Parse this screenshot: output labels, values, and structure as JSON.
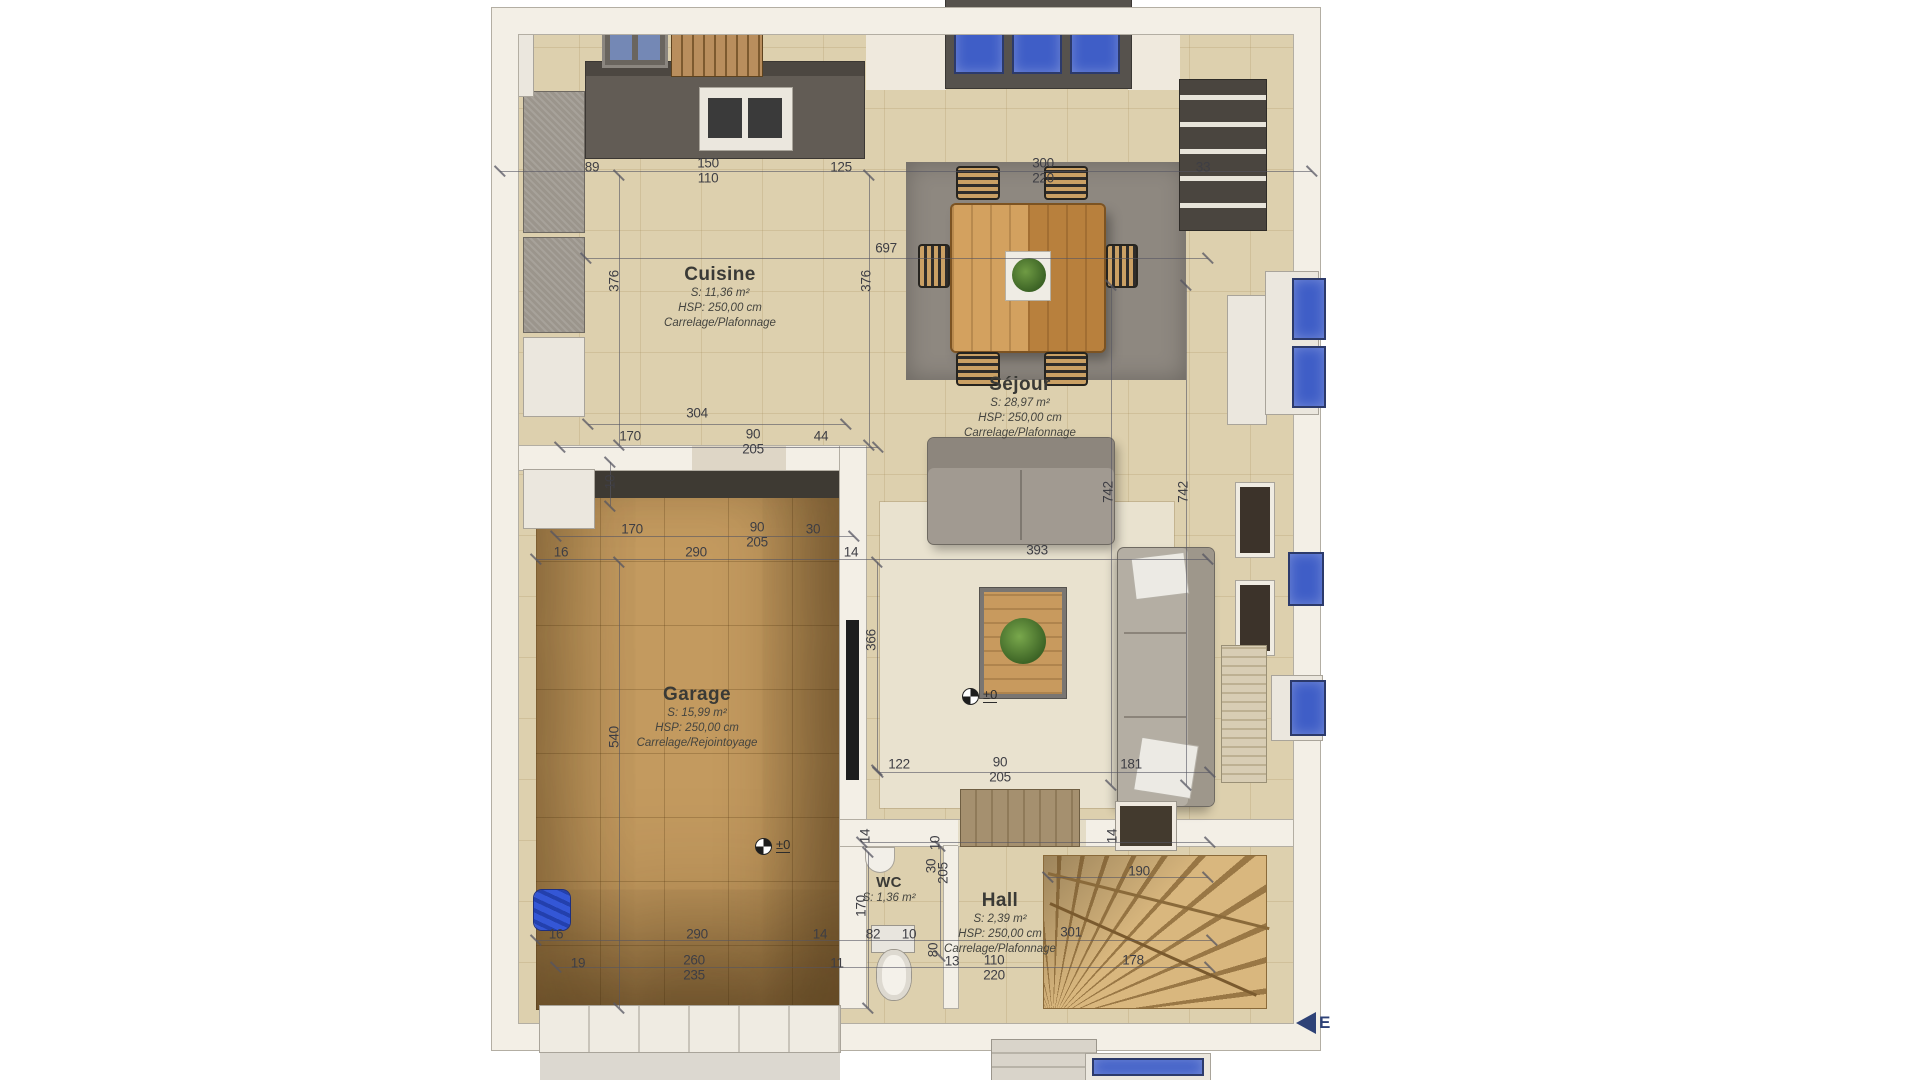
{
  "plan": {
    "rooms": [
      {
        "id": "cuisine",
        "name": "Cuisine",
        "area": "S: 11,36 m²",
        "height": "HSP: 250,00 cm",
        "finish": "Carrelage/Plafonnage"
      },
      {
        "id": "sejour",
        "name": "Séjour",
        "area": "S: 28,97 m²",
        "height": "HSP: 250,00 cm",
        "finish": "Carrelage/Plafonnage"
      },
      {
        "id": "garage",
        "name": "Garage",
        "area": "S: 15,99 m²",
        "height": "HSP: 250,00 cm",
        "finish": "Carrelage/Rejointoyage"
      },
      {
        "id": "wc",
        "name": "WC",
        "area": "S: 1,36 m²",
        "height": "",
        "finish": ""
      },
      {
        "id": "hall",
        "name": "Hall",
        "area": "S: 2,39 m²",
        "height": "HSP: 250,00 cm",
        "finish": "Carrelage/Plafonnage"
      }
    ],
    "level_markers": [
      {
        "label": "±0"
      },
      {
        "label": "±0"
      }
    ],
    "compass": {
      "label": "E"
    },
    "dimensions": [
      {
        "v": "89",
        "x": 592,
        "y": 167
      },
      {
        "v": "150",
        "x": 708,
        "y": 163
      },
      {
        "v": "110",
        "x": 708,
        "y": 178
      },
      {
        "v": "125",
        "x": 841,
        "y": 167
      },
      {
        "v": "300",
        "x": 1043,
        "y": 163
      },
      {
        "v": "220",
        "x": 1043,
        "y": 178
      },
      {
        "v": "33",
        "x": 1203,
        "y": 167
      },
      {
        "v": "697",
        "x": 886,
        "y": 248
      },
      {
        "v": "376",
        "x": 614,
        "y": 281,
        "r": 1
      },
      {
        "v": "376",
        "x": 866,
        "y": 281,
        "r": 1
      },
      {
        "v": "304",
        "x": 697,
        "y": 413
      },
      {
        "v": "170",
        "x": 630,
        "y": 436
      },
      {
        "v": "90",
        "x": 753,
        "y": 434
      },
      {
        "v": "205",
        "x": 753,
        "y": 449
      },
      {
        "v": "44",
        "x": 821,
        "y": 436
      },
      {
        "v": "10",
        "x": 610,
        "y": 482,
        "r": 1
      },
      {
        "v": "170",
        "x": 632,
        "y": 529
      },
      {
        "v": "90",
        "x": 757,
        "y": 527
      },
      {
        "v": "205",
        "x": 757,
        "y": 542
      },
      {
        "v": "30",
        "x": 813,
        "y": 529
      },
      {
        "v": "16",
        "x": 561,
        "y": 552
      },
      {
        "v": "290",
        "x": 696,
        "y": 552
      },
      {
        "v": "14",
        "x": 851,
        "y": 552
      },
      {
        "v": "393",
        "x": 1037,
        "y": 550
      },
      {
        "v": "366",
        "x": 871,
        "y": 640,
        "r": 1
      },
      {
        "v": "742",
        "x": 1108,
        "y": 492,
        "r": 1
      },
      {
        "v": "742",
        "x": 1183,
        "y": 492,
        "r": 1
      },
      {
        "v": "122",
        "x": 899,
        "y": 764
      },
      {
        "v": "90",
        "x": 1000,
        "y": 762
      },
      {
        "v": "205",
        "x": 1000,
        "y": 777
      },
      {
        "v": "181",
        "x": 1131,
        "y": 764
      },
      {
        "v": "540",
        "x": 614,
        "y": 737,
        "r": 1
      },
      {
        "v": "290",
        "x": 697,
        "y": 934
      },
      {
        "v": "16",
        "x": 556,
        "y": 934
      },
      {
        "v": "14",
        "x": 820,
        "y": 934
      },
      {
        "v": "82",
        "x": 873,
        "y": 934
      },
      {
        "v": "10",
        "x": 909,
        "y": 934
      },
      {
        "v": "19",
        "x": 578,
        "y": 963
      },
      {
        "v": "260",
        "x": 694,
        "y": 960
      },
      {
        "v": "235",
        "x": 694,
        "y": 975
      },
      {
        "v": "11",
        "x": 837,
        "y": 963
      },
      {
        "v": "80",
        "x": 933,
        "y": 950,
        "r": 1
      },
      {
        "v": "13",
        "x": 952,
        "y": 961
      },
      {
        "v": "110",
        "x": 994,
        "y": 960
      },
      {
        "v": "220",
        "x": 994,
        "y": 975
      },
      {
        "v": "178",
        "x": 1133,
        "y": 960
      },
      {
        "v": "301",
        "x": 1071,
        "y": 932
      },
      {
        "v": "190",
        "x": 1139,
        "y": 871
      },
      {
        "v": "170",
        "x": 861,
        "y": 906,
        "r": 1
      },
      {
        "v": "205",
        "x": 943,
        "y": 873,
        "r": 1
      },
      {
        "v": "30",
        "x": 931,
        "y": 866,
        "r": 1
      },
      {
        "v": "14",
        "x": 865,
        "y": 836,
        "r": 1
      },
      {
        "v": "10",
        "x": 935,
        "y": 843,
        "r": 1
      },
      {
        "v": "14",
        "x": 1112,
        "y": 836,
        "r": 1
      }
    ],
    "colors": {
      "floor_tile": "#ddd0ae",
      "garage_floor": "#c39a5f",
      "wall": "#f3efe6",
      "wall_line": "#b3aea3",
      "counter": "#625c55",
      "dining_rug": "#8e8880",
      "sejour_rug": "#e9e2cf",
      "stair_wood": "#d9b77e",
      "sofa": "#a19a91",
      "window_glass": "#3f5ec7",
      "dim_text": "#3e3e44",
      "accent_blue": "#3457d6"
    }
  }
}
